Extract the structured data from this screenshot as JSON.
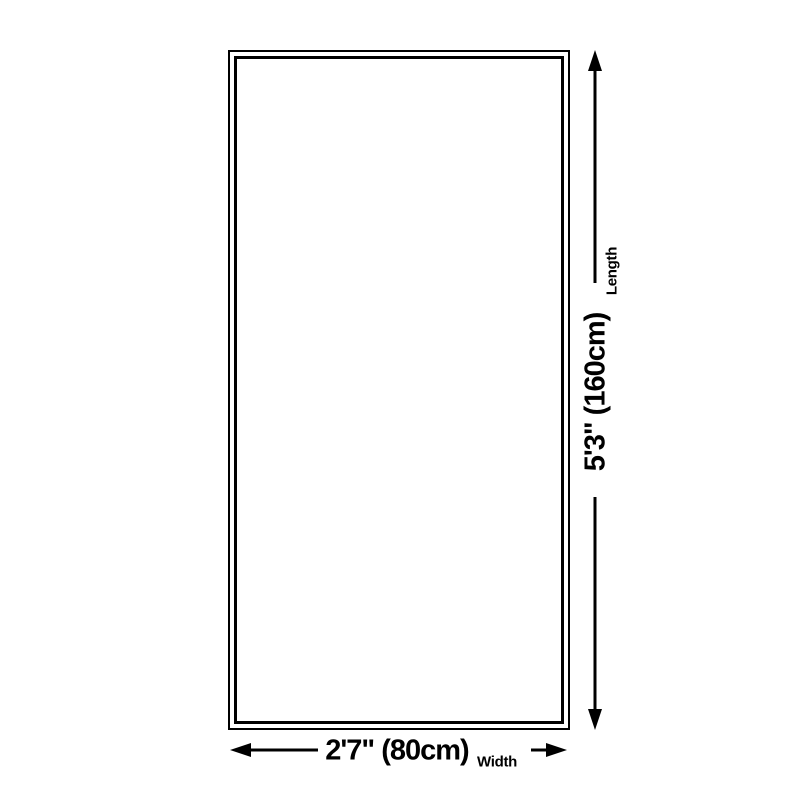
{
  "diagram": {
    "type": "product-dimension-diagram",
    "shape": "rectangle",
    "length": {
      "value": "5'3\" (160cm)",
      "label": "Length"
    },
    "width": {
      "value": "2'7\" (80cm)",
      "label": "Width"
    },
    "colors": {
      "line": "#000000",
      "background": "#ffffff"
    }
  }
}
